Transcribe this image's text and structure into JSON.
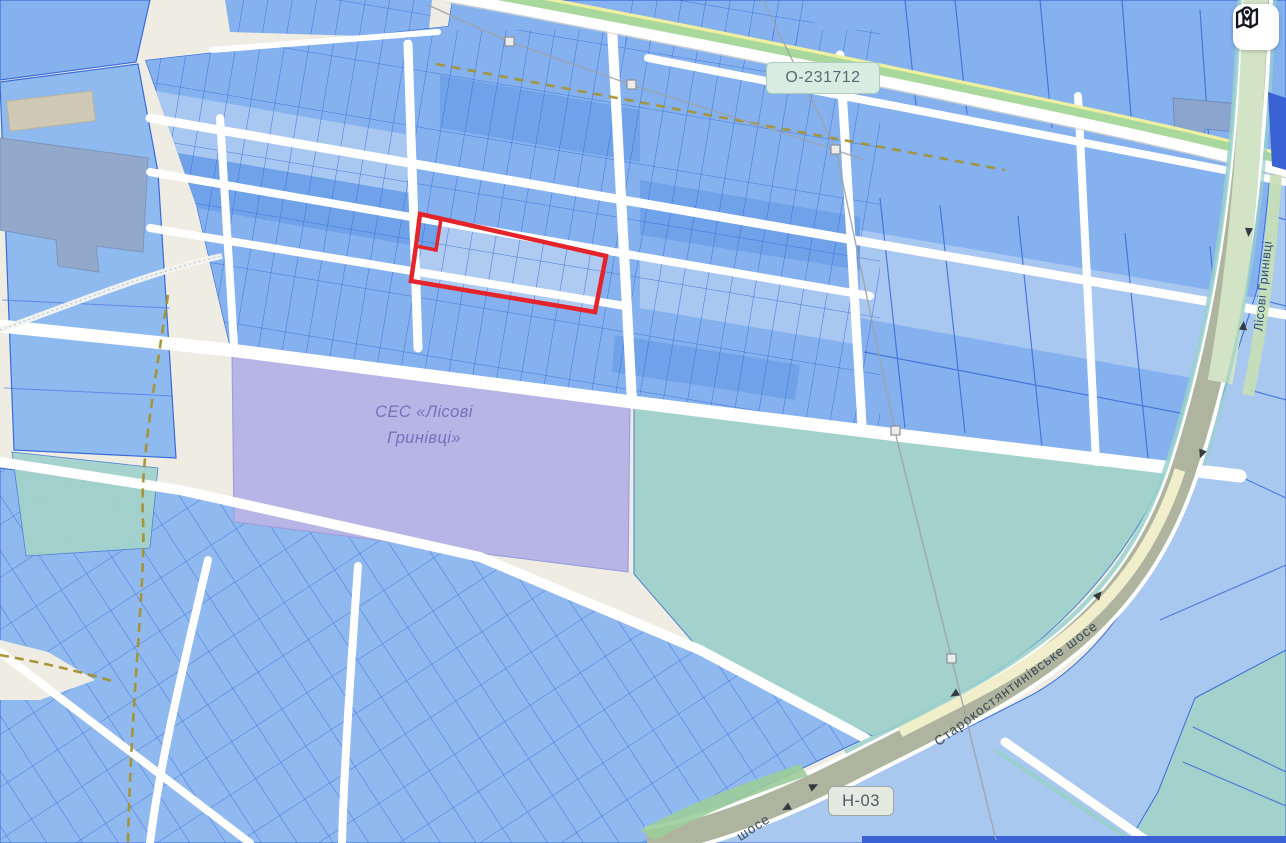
{
  "labels": {
    "road_ref_top": "О-231712",
    "road_ref_bottom": "Н-03",
    "highway_name": "Старокостянтинівське шосе",
    "highway_name_fragment": "шосе",
    "street_right": "Лісові Гринівці",
    "solar_station_line1": "СЕС «Лісові",
    "solar_station_line2": "Гринівці»"
  },
  "icons": {
    "map_button": "map-location-icon"
  },
  "selected_parcel": {
    "outline_color": "#E4232B"
  },
  "colors": {
    "background": "#EFEDE3",
    "parcel_fill": "#85B2EE",
    "parcel_fill_light": "#A9C8F1",
    "parcel_fill_dark": "#6FA2E9",
    "parcel_border": "#3A6BD8",
    "selected_parcel_fill": "#AFCBF2",
    "solar_area_fill": "#B7B5E6",
    "field_fill": "#A3D2CC",
    "highway_fill": "#AEB49D",
    "highway_green_fill": "#D3E3C6",
    "roadside_green": "#A8D89C",
    "road_center_yellow": "#EFEFA2",
    "stream_teal": "#9AD0CB",
    "track_dash": "#A5912F",
    "navy_strip": "#3B62D4",
    "road_white": "#FFFFFF"
  }
}
